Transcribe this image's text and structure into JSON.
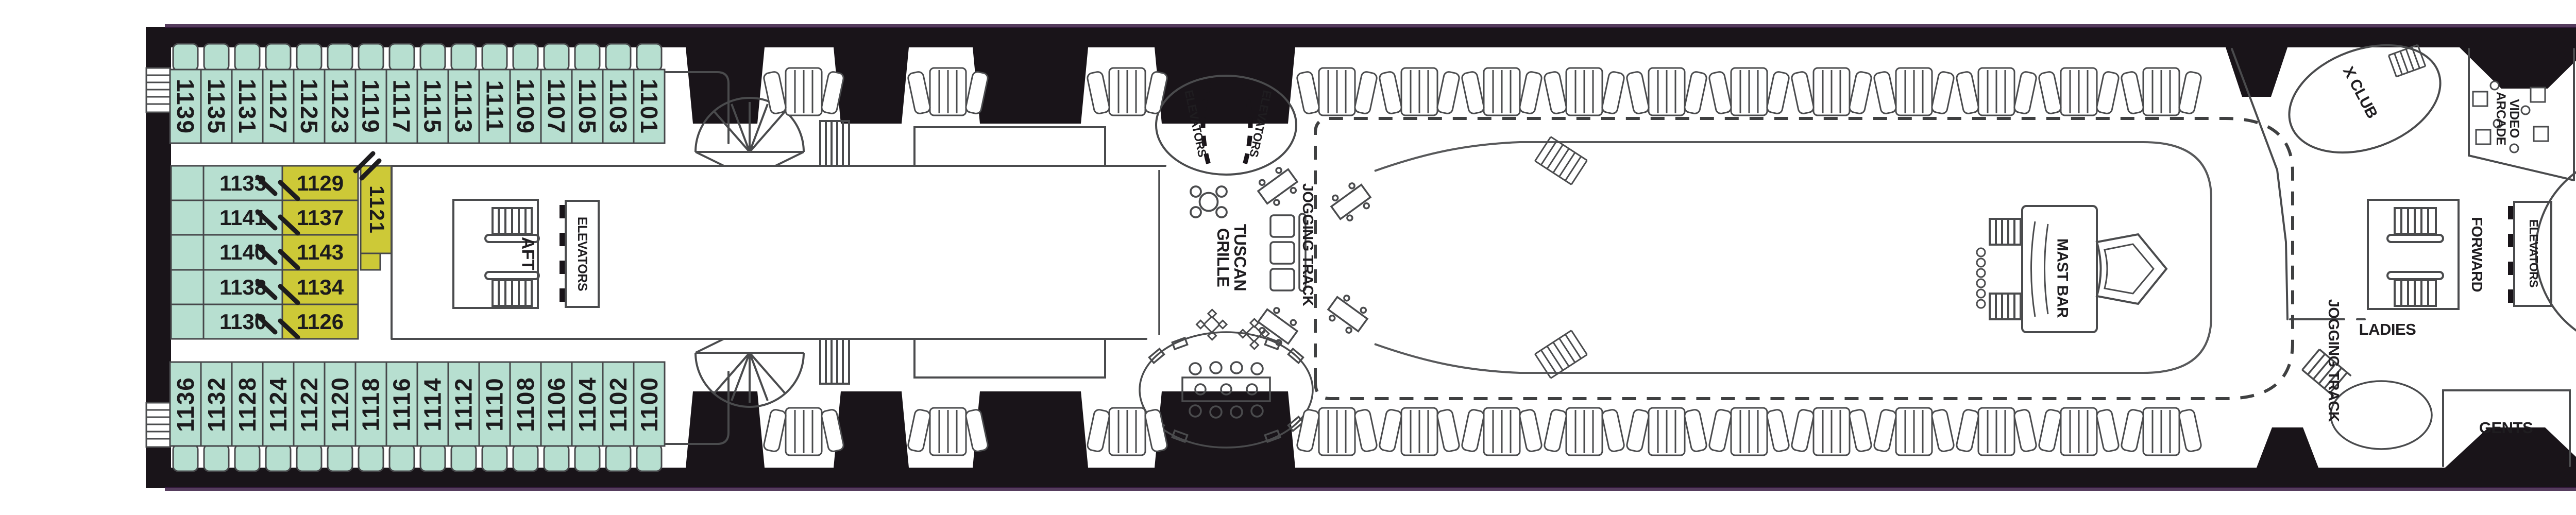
{
  "title": "Cruise ship deck plan",
  "colors": {
    "cabin_teal": "#b7dfd0",
    "cabin_yellow": "#cdc937",
    "hull_black": "#191419",
    "line_gray": "#4a4b4d",
    "accent_purple": "#371a41"
  },
  "deck": {
    "cabins": {
      "top_row": [
        "1139",
        "1135",
        "1131",
        "1127",
        "1125",
        "1123",
        "1119",
        "1117",
        "1115",
        "1113",
        "1111",
        "1109",
        "1107",
        "1105",
        "1103",
        "1101"
      ],
      "bottom_row": [
        "1136",
        "1132",
        "1128",
        "1124",
        "1122",
        "1120",
        "1118",
        "1116",
        "1114",
        "1112",
        "1110",
        "1108",
        "1106",
        "1104",
        "1102",
        "1100"
      ],
      "mid_teal": [
        "1133",
        "1141",
        "1140",
        "1138",
        "1130"
      ],
      "mid_yellow": [
        "1129",
        "1137",
        "1143",
        "1134",
        "1126"
      ],
      "mid_vertical": "1121"
    },
    "labels": {
      "aft": "AFT",
      "forward": "FORWARD",
      "elevators": "ELEVATORS",
      "tuscan_grille": "TUSCAN GRILLE",
      "jogging_track": "JOGGING TRACK",
      "mast_bar": "MAST BAR",
      "x_club": "X CLUB",
      "video_arcade": "VIDEO ARCADE",
      "ladies": "LADIES",
      "gents": "GENTS",
      "fun_factory": "FUN FACTORY",
      "reflections_lounge": "REFLECTIONS LOUNGE"
    }
  }
}
